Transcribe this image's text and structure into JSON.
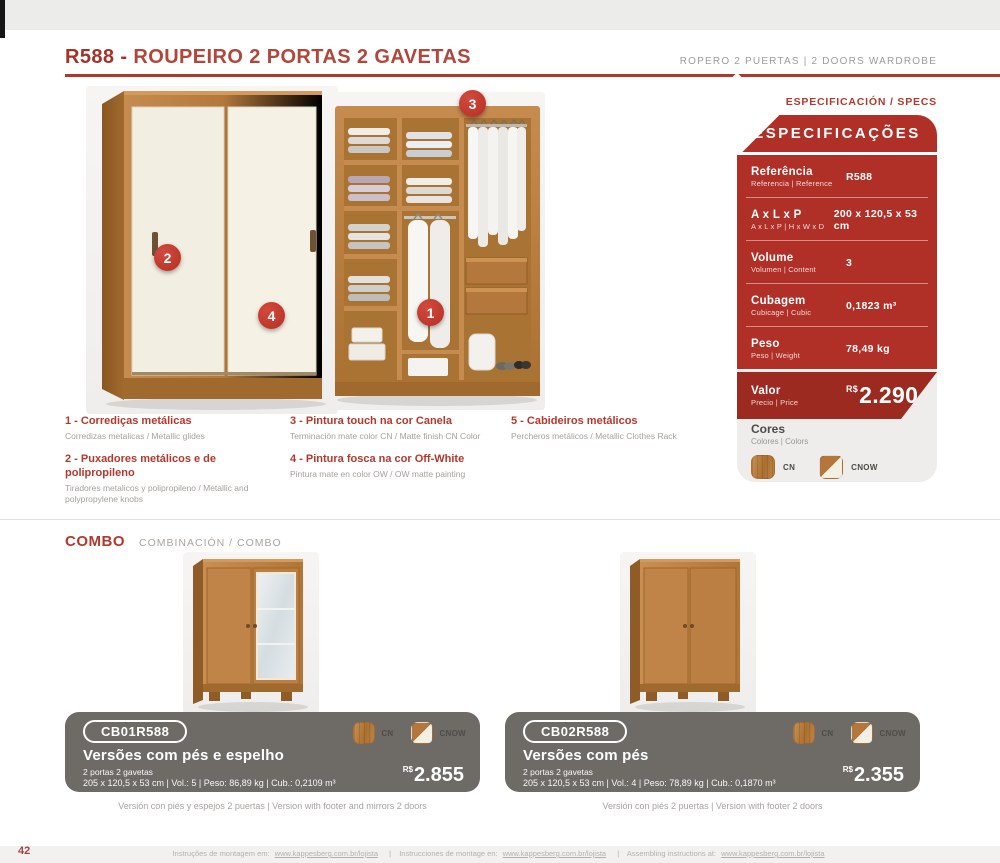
{
  "header": {
    "code": "R588 -",
    "title": "ROUPEIRO 2 PORTAS 2 GAVETAS",
    "subtitle": "ROPERO 2 PUERTAS  |  2 DOORS WARDROBE"
  },
  "callouts": {
    "n1": "1",
    "n2": "2",
    "n3": "3",
    "n4": "4",
    "n5": "5"
  },
  "features": [
    {
      "title": "1 - Corrediças metálicas",
      "subtitle": "Corredizas metalicas / Metallic glides"
    },
    {
      "title": "2 - Puxadores metálicos e de polipropileno",
      "subtitle": "Tiradores metalicos y polipropileno / Metallic and polypropylene knobs"
    },
    {
      "title": "3 - Pintura touch na cor Canela",
      "subtitle": "Terminación mate color CN  / Matte finish CN Color"
    },
    {
      "title": "4 - Pintura fosca na cor Off-White",
      "subtitle": "Pintura mate en color OW / OW matte painting"
    },
    {
      "title": "5 - Cabideiros metálicos",
      "subtitle": "Percheros metálicos / Metallic Clothes Rack"
    }
  ],
  "specs": {
    "label": "ESPECIFICACIÓN / SPECS",
    "title": "ESPECIFICAÇÕES",
    "rows": [
      {
        "name": "Referência",
        "sub": "Referencia | Reference",
        "value": "R588"
      },
      {
        "name": "A x L x P",
        "sub": "A x L x P  |  H x W x D",
        "value": "200 x 120,5 x 53 cm"
      },
      {
        "name": "Volume",
        "sub": "Volumen  |  Content",
        "value": "3"
      },
      {
        "name": "Cubagem",
        "sub": "Cubicage  |  Cubic",
        "value": "0,1823 m³"
      },
      {
        "name": "Peso",
        "sub": "Peso  |  Weight",
        "value": "78,49 kg"
      }
    ],
    "price_row": {
      "name": "Valor",
      "sub": "Precio  |  Price",
      "currency": "R$",
      "value": "2.290"
    },
    "colors": {
      "name": "Cores",
      "sub": "Colores | Colors",
      "options": [
        {
          "code": "CN"
        },
        {
          "code": "CNOW"
        }
      ]
    }
  },
  "combo": {
    "title": "COMBO",
    "subtitle": "COMBINACIÓN / COMBO",
    "items": [
      {
        "code": "CB01R588",
        "title": "Versões com pés e espelho",
        "line1": "2 portas 2 gavetas",
        "line2": "205 x 120,5 x 53 cm | Vol.: 5 | Peso: 86,89 kg | Cub.: 0,2109 m³",
        "currency": "R$",
        "price": "2.855",
        "colors": [
          "CN",
          "CNOW"
        ],
        "caption": "Versión con piés y espejos 2 puertas  |  Version with footer and mirrors 2 doors"
      },
      {
        "code": "CB02R588",
        "title": "Versões com pés",
        "line1": "2 portas 2 gavetas",
        "line2": "205 x 120,5 x 53 cm | Vol.: 4 | Peso: 78,89 kg | Cub.: 0,1870 m³",
        "currency": "R$",
        "price": "2.355",
        "colors": [
          "CN",
          "CNOW"
        ],
        "caption": "Versión con piés 2 puertas  |  Version with footer 2 doors"
      }
    ]
  },
  "page": {
    "number": "42"
  },
  "footer": {
    "pt": "Instruções de montagem em:",
    "es": "Instrucciones de montage en:",
    "en": "Assembling instructions at:",
    "url": "www.kappesberg.com.br/lojista",
    "sep": "|"
  },
  "palette": {
    "accent_red": "#b5382c",
    "panel_red": "#b02f27",
    "panel_dark_red": "#9c2a20",
    "card_gray": "#6e6b67",
    "specs_gray": "#efedeb",
    "wood": "#b5783c"
  }
}
